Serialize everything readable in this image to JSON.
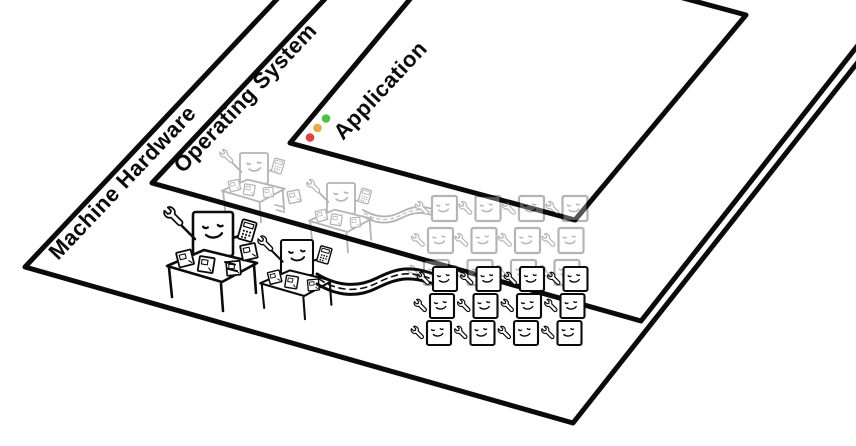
{
  "diagram": {
    "layers": [
      {
        "label": "Machine Hardware"
      },
      {
        "label": "Operating System"
      },
      {
        "label": "Application"
      }
    ],
    "window_controls": {
      "buttons": [
        {
          "name": "close",
          "color": "#e2403a"
        },
        {
          "name": "minimize",
          "color": "#f0a73f"
        },
        {
          "name": "maximize",
          "color": "#4ec43c"
        }
      ]
    },
    "ink_color": "#0b0b0b",
    "faded_opacity": "0.3",
    "scene": {
      "hardware_desk_workers": 2,
      "hardware_mini_workers": 12,
      "os_desk_workers": 2,
      "os_mini_workers": 12
    }
  }
}
